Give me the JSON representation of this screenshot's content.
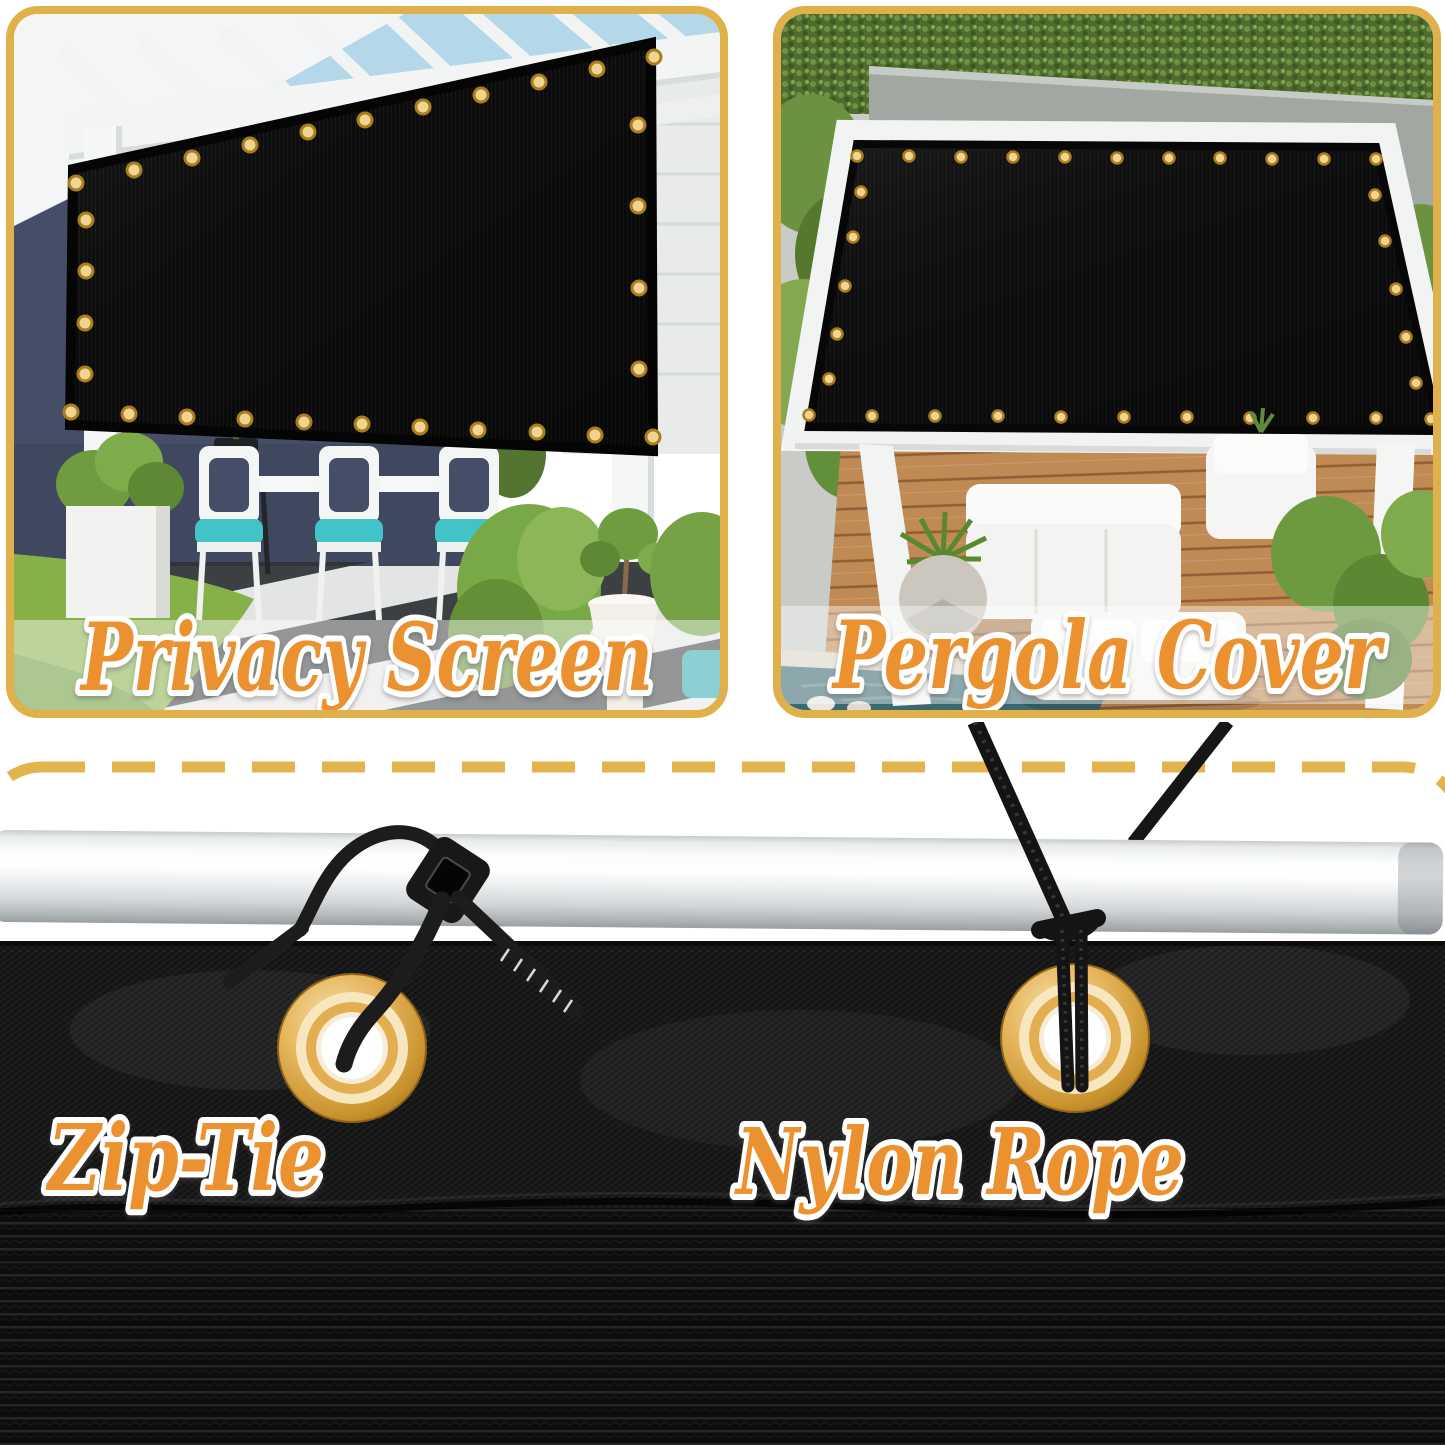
{
  "image_type": "shade-screen-product-infographic",
  "accent": {
    "panel_border_gold": "#E0B04B",
    "dashed_line_gold": "#E3B44C",
    "label_fill_orange": "#EC9130",
    "label_outline": "#FFFFFF"
  },
  "panels": {
    "privacy": {
      "label": "Privacy Screen"
    },
    "pergola": {
      "label": "Pergola Cover"
    }
  },
  "hardware": {
    "zip_tie": {
      "label": "Zip-Tie"
    },
    "nylon_rope": {
      "label": "Nylon Rope"
    },
    "grommet_color": "#D8A33E",
    "fabric_color": "#121212",
    "pole_color": "#E6E8E9"
  }
}
